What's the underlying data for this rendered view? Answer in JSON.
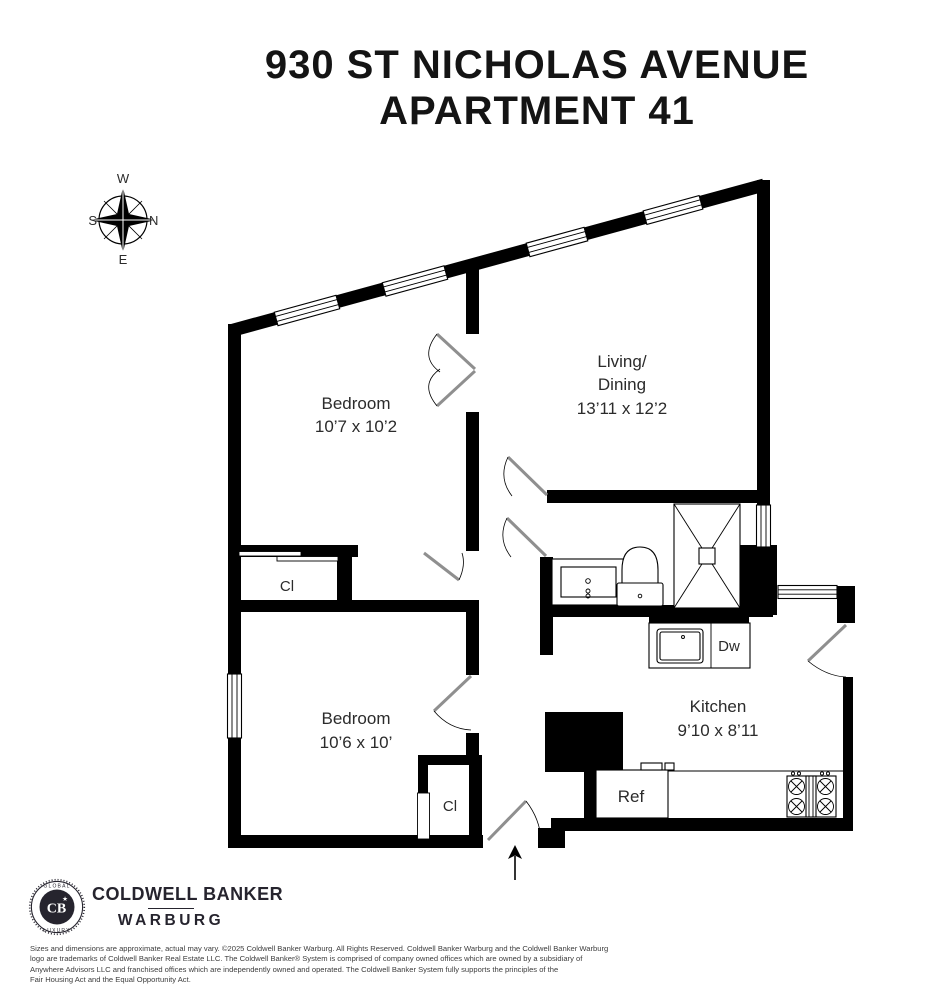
{
  "title": {
    "line1": "930 ST NICHOLAS AVENUE",
    "line2": "APARTMENT 41"
  },
  "compass": {
    "n": "N",
    "s": "S",
    "e": "E",
    "w": "W"
  },
  "rooms": {
    "bedroom1": {
      "name": "Bedroom",
      "dims": "10’7 x 10’2"
    },
    "living": {
      "line1": "Living/",
      "line2": "Dining",
      "dims": "13’11 x 12’2"
    },
    "bedroom2": {
      "name": "Bedroom",
      "dims": "10’6 x 10’"
    },
    "kitchen": {
      "name": "Kitchen",
      "dims": "9’10 x 8’11"
    }
  },
  "fixtures": {
    "closet1": "Cl",
    "closet2": "Cl",
    "dishwasher": "Dw",
    "refrigerator": "Ref"
  },
  "footer": {
    "badge_top": "GLOBAL",
    "badge_bottom": "LUXURY",
    "badge_monogram": "CB",
    "brand_line1": "COLDWELL BANKER",
    "brand_line2": "WARBURG",
    "disclaimer": [
      "Sizes and dimensions are approximate, actual may vary.  ©2025 Coldwell Banker Warburg. All Rights Reserved. Coldwell Banker Warburg and the Coldwell Banker Warburg",
      "logo are trademarks of Coldwell Banker Real Estate LLC. The Coldwell Banker® System is comprised of company owned offices which are owned by a subsidiary of",
      "Anywhere Advisors LLC and franchised offices which are independently owned and operated. The Coldwell Banker System fully supports the principles of the",
      "Fair Housing Act and the Equal Opportunity Act."
    ]
  },
  "colors": {
    "wall": "#000000",
    "text": "#2b2b2b",
    "brand": "#26242e"
  }
}
